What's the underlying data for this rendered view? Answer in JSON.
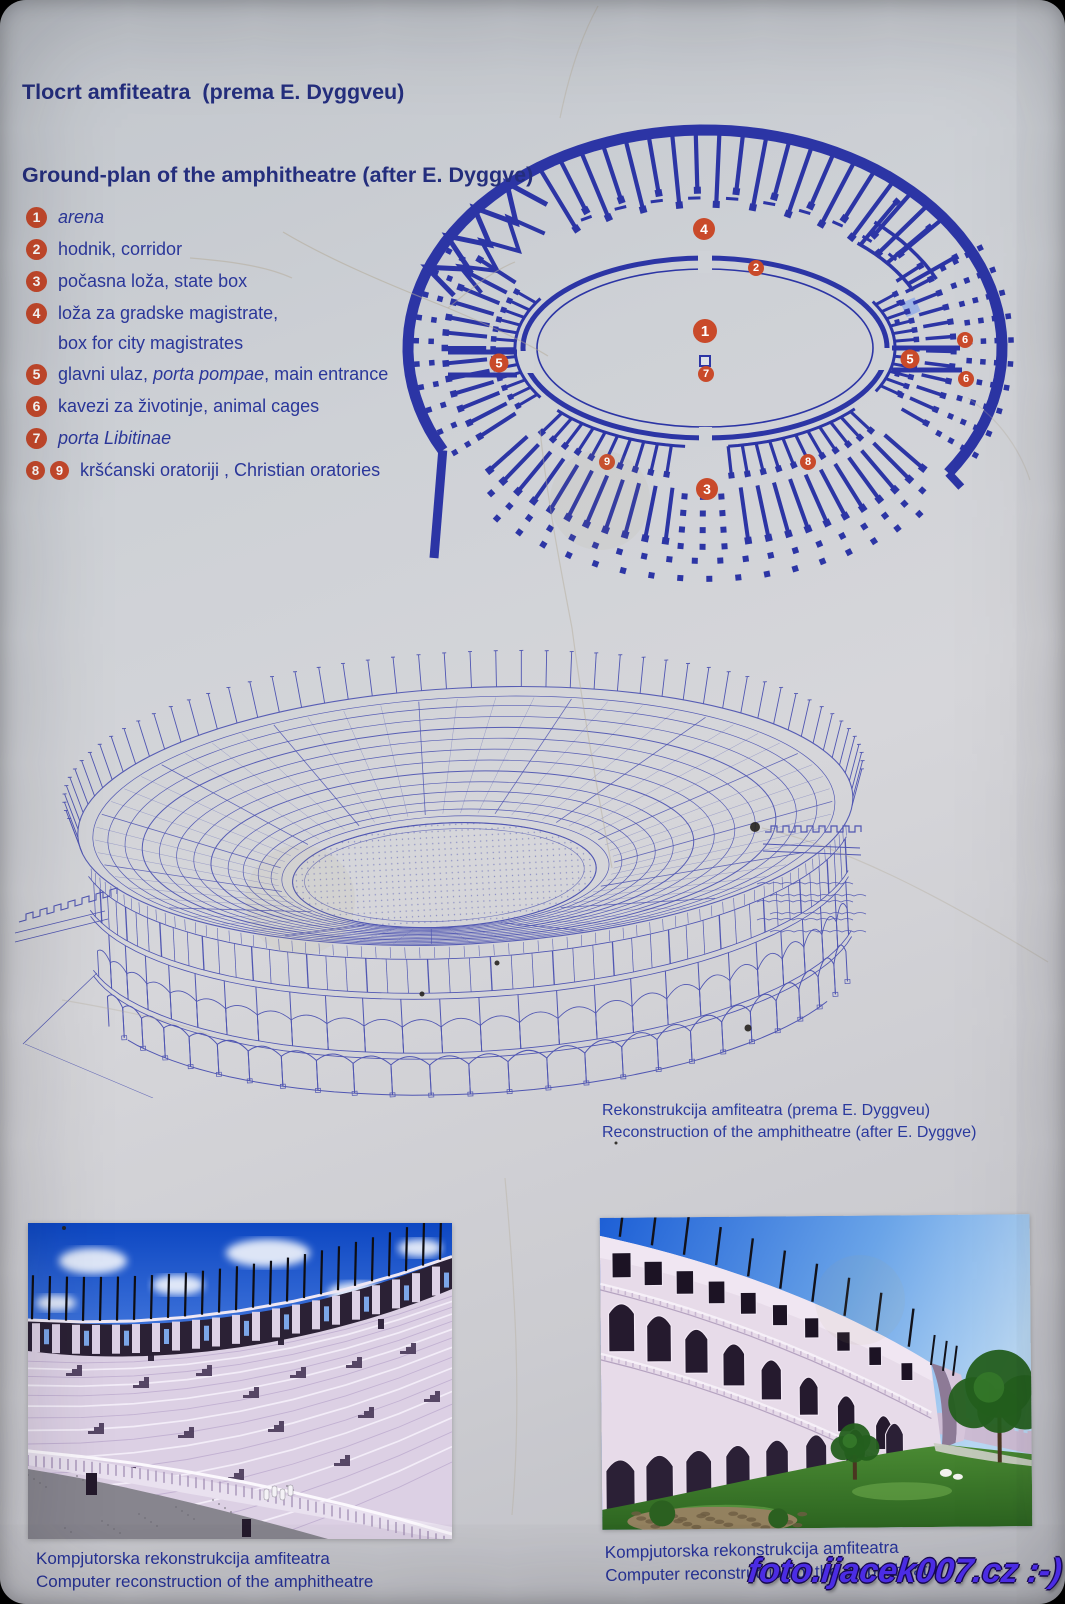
{
  "colors": {
    "plan_blue": "#2c35a5",
    "text_blue": "#2b379a",
    "title_blue": "#242e7d",
    "marker_red": "#c94a2a",
    "recon_ink": "#5056b2",
    "watermark_purple": "#4b2ce4"
  },
  "header": {
    "title_hr": "Tlocrt amfiteatra  (prema E. Dyggveu)",
    "title_en": "Ground-plan of the amphitheatre (after E. Dyggve)"
  },
  "legend": {
    "items": [
      {
        "badges": [
          "1"
        ],
        "pre": "",
        "em": "arena",
        "post": ""
      },
      {
        "badges": [
          "2"
        ],
        "pre": "hodnik, corridor",
        "em": "",
        "post": ""
      },
      {
        "badges": [
          "3"
        ],
        "pre": "počasna loža, state box",
        "em": "",
        "post": ""
      },
      {
        "badges": [
          "4"
        ],
        "pre": "loža za gradske magistrate,",
        "em": "",
        "post": "",
        "line2": "box for city magistrates"
      },
      {
        "badges": [
          "5"
        ],
        "pre": "glavni ulaz, ",
        "em": "porta pompae",
        "post": ", main entrance"
      },
      {
        "badges": [
          "6"
        ],
        "pre": "kavezi za životinje, animal cages",
        "em": "",
        "post": ""
      },
      {
        "badges": [
          "7"
        ],
        "pre": "",
        "em": "porta Libitinae",
        "post": ""
      },
      {
        "badges": [
          "8",
          "9"
        ],
        "pre": "kršćanski oratoriji , Christian oratories",
        "em": "",
        "post": ""
      }
    ]
  },
  "plan": {
    "markers": [
      {
        "label": "4"
      },
      {
        "label": "2"
      },
      {
        "label": "1"
      },
      {
        "label": "7"
      },
      {
        "label": "5"
      },
      {
        "label": "5"
      },
      {
        "label": "6"
      },
      {
        "label": "6"
      },
      {
        "label": "9"
      },
      {
        "label": "8"
      },
      {
        "label": "3"
      }
    ]
  },
  "recon_caption": {
    "line1": "Rekonstrukcija amfiteatra (prema E. Dyggveu)",
    "line2": "Reconstruction of the amphitheatre (after E. Dyggve)"
  },
  "photo_left": {
    "caption1": "Kompjutorska rekonstrukcija amfiteatra",
    "caption2": "Computer reconstruction of the amphitheatre"
  },
  "photo_right": {
    "caption1": "Kompjutorska rekonstrukcija amfiteatra",
    "caption2": "Computer reconstruction of the amphitheatre"
  },
  "watermark": "foto.ijacek007.cz :-)"
}
